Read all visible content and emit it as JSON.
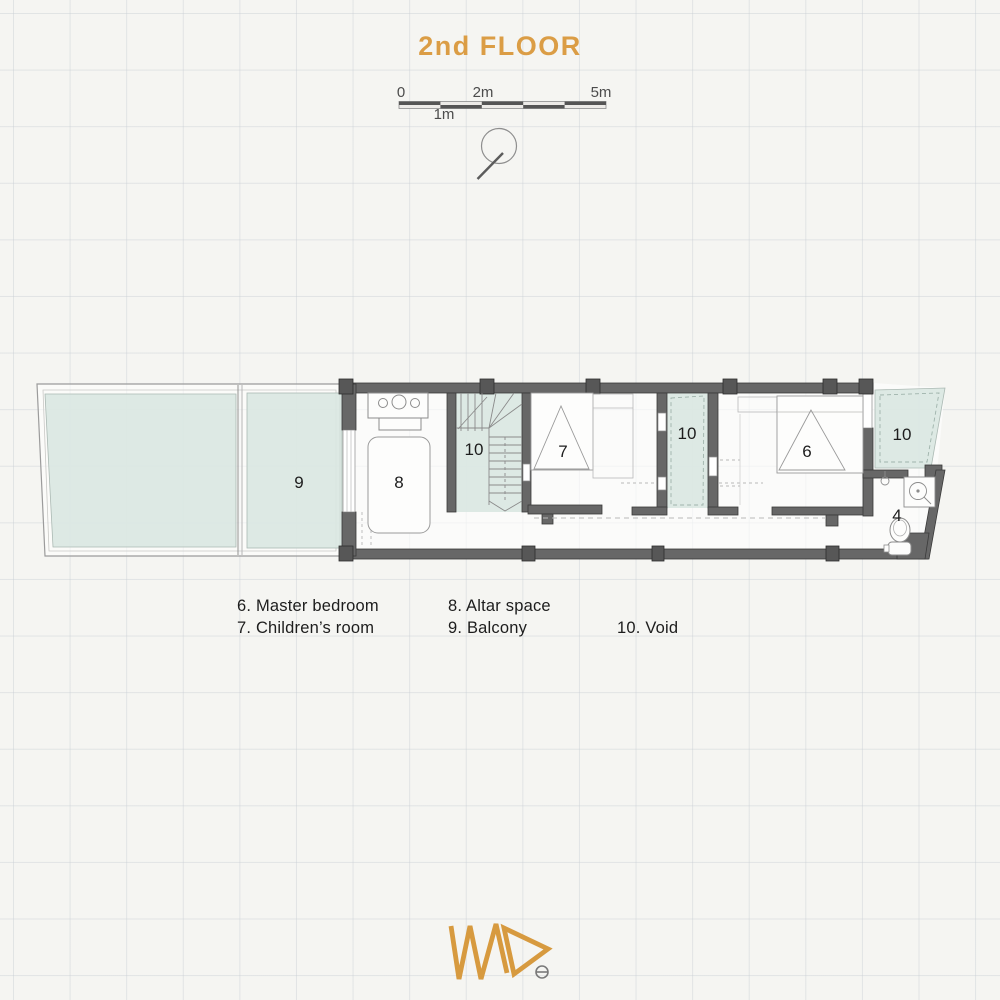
{
  "title": "2nd FLOOR",
  "scale_bar": {
    "zero": "0",
    "two_m": "2m",
    "five_m": "5m",
    "one_m": "1m"
  },
  "rooms": {
    "balcony": "9",
    "altar": "8",
    "stair_void": "10",
    "children": "7",
    "mid_void": "10",
    "master": "6",
    "right_void": "10",
    "bathroom": "4"
  },
  "legend": {
    "col1": [
      {
        "label": "6. Master bedroom"
      },
      {
        "label": "7. Children’s room"
      }
    ],
    "col2": [
      {
        "label": "8. Altar space"
      },
      {
        "label": "9. Balcony"
      }
    ],
    "col3": [
      {
        "label": "10. Void"
      }
    ]
  },
  "logo": {
    "name": "MAD"
  },
  "colors": {
    "accent": "#DB9D45",
    "wall": "#676767",
    "column": "#575757",
    "void_fill": "#DCE9E4",
    "line": "#8C8C8C"
  }
}
